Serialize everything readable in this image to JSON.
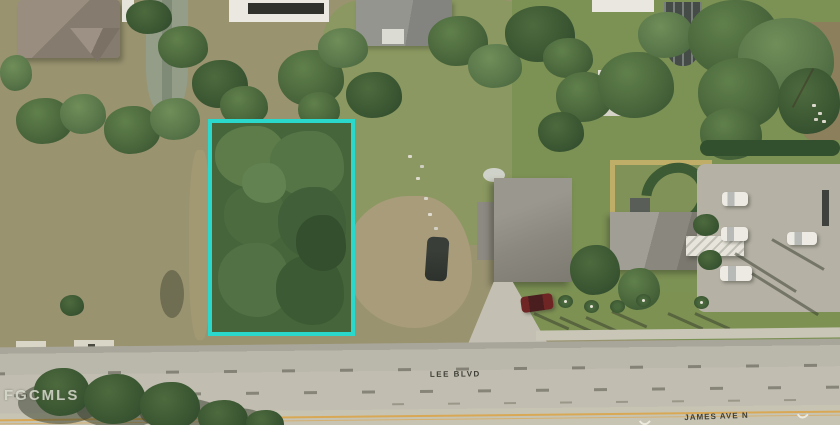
{
  "map": {
    "watermark": "FGCMLS",
    "street_labels": {
      "lee_blvd": "LEE BLVD",
      "james_ave_n": "JAMES AVE N"
    },
    "parcel": {
      "outline_color": "#2BD8CC"
    },
    "road": {
      "centerline_color": "#D8A855"
    }
  }
}
